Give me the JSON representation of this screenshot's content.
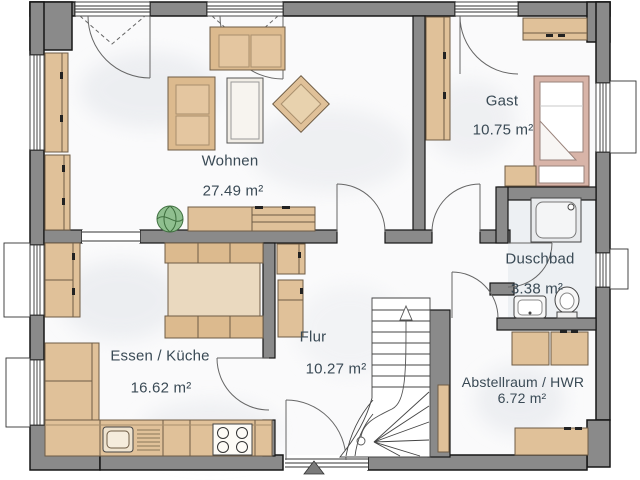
{
  "plan": {
    "rooms": [
      {
        "id": "wohnen",
        "label": "Wohnen",
        "area": "27.49 m²"
      },
      {
        "id": "gast",
        "label": "Gast",
        "area": "10.75 m²"
      },
      {
        "id": "duschbad",
        "label": "Duschbad",
        "area": "3.38 m²"
      },
      {
        "id": "essen_kueche",
        "label": "Essen / Küche",
        "area": "16.62 m²"
      },
      {
        "id": "flur",
        "label": "Flur",
        "area": "10.27 m²"
      },
      {
        "id": "abstellraum",
        "label": "Abstellraum / HWR",
        "area": "6.72 m²"
      }
    ],
    "colors": {
      "wall": "#8a8a8a",
      "wall_outline": "#161616",
      "wood": "#e0c199",
      "wood_outline": "#6e5c45",
      "bed_frame": "#d8b4a8",
      "plant": "#8fbf8f",
      "label_text": "#3a4a55",
      "floor": "#fafafa"
    }
  }
}
